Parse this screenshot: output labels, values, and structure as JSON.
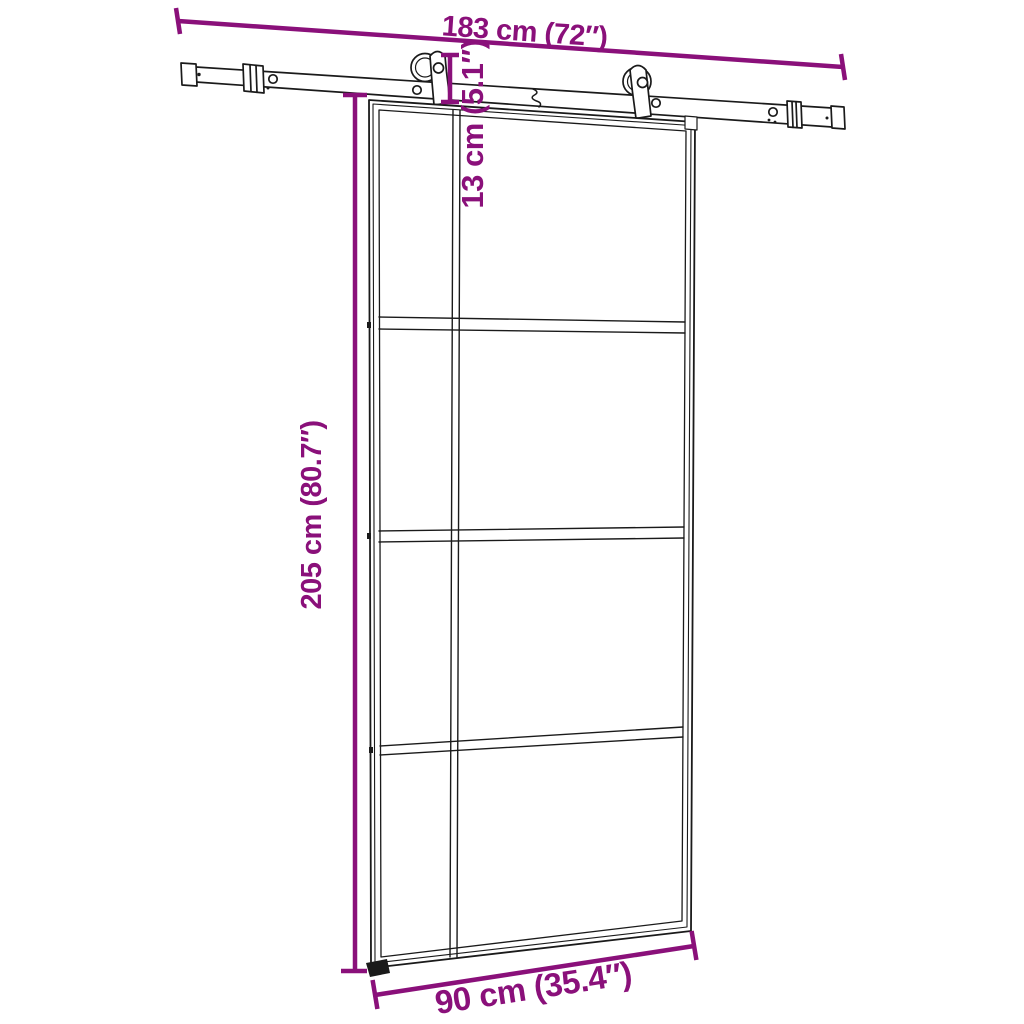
{
  "colors": {
    "dimension_accent": "#8a107a",
    "line_art": "#1a1a1a",
    "background": "#ffffff"
  },
  "dimension_labels": {
    "rail_length": "183 cm (72″)",
    "hanger_height": "13 cm (5.1″)",
    "door_height": "205 cm (80.7″)",
    "door_width": "90 cm (35.4″)"
  }
}
